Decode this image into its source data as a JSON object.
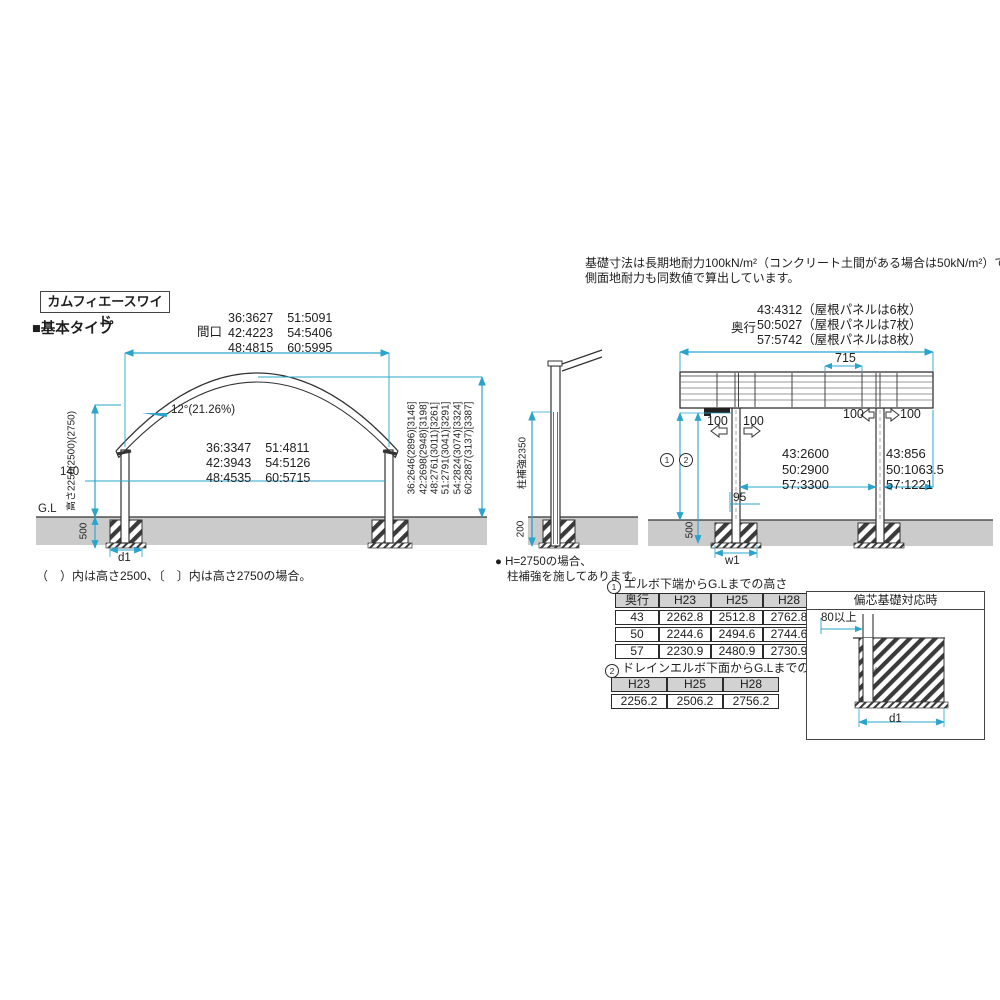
{
  "colors": {
    "accent": "#2AA4CC",
    "ground": "#cbcbcb",
    "line": "#333333",
    "table_header_bg": "#d2d2d2"
  },
  "header": {
    "product_name": "カムフィエースワイド",
    "section_title": "■基本タイプ"
  },
  "top_note": {
    "line1": "基礎寸法は長期地耐力100kN/m²（コンクリート土間がある場合は50kN/m²）での設定です。",
    "line2": "側面地耐力も同数値で算出しています。"
  },
  "front": {
    "width_prefix": "間口",
    "width_values": [
      [
        "36:3627",
        "51:5091"
      ],
      [
        "42:4223",
        "54:5406"
      ],
      [
        "48:4815",
        "60:5995"
      ]
    ],
    "slope_label": "12°(21.26%)",
    "inner_values": [
      [
        "36:3347",
        "51:4811"
      ],
      [
        "42:3943",
        "54:5126"
      ],
      [
        "48:4535",
        "60:5715"
      ]
    ],
    "height_label": "高さ2250(2500)(2750)",
    "dim_140": "140",
    "dim_500": "500",
    "gl_label": "G.L",
    "dim_d1": "d1",
    "total_heights": [
      "36:2646(2896)[3146]",
      "42:2698(2948)[3198]",
      "48:2761(3011)[3261]",
      "51:2791(3041)[3291]",
      "54:2824(3074)[3324]",
      "60:2887(3137)[3387]"
    ],
    "caption": "（　）内は高さ2500、〔　〕内は高さ2750の場合。"
  },
  "pillar": {
    "dim_label": "柱補強2350",
    "dim_200": "200",
    "note1": "● H=2750の場合、",
    "note2": "柱補強を施してあります。"
  },
  "side": {
    "depth_prefix": "奥行",
    "depth_values": [
      "43:4312（屋根パネルは6枚）",
      "50:5027（屋根パネルは7枚）",
      "57:5742（屋根パネルは8枚）"
    ],
    "dim_715": "715",
    "dim_100": "100",
    "span_values": [
      "43:2600",
      "50:2900",
      "57:3300"
    ],
    "overhang_values": [
      "43:856",
      "50:1063.5",
      "57:1221"
    ],
    "dim_95": "95",
    "dim_500": "500",
    "dim_w1": "w1",
    "circ1": "1",
    "circ2": "2"
  },
  "tables": {
    "t1_num": "1",
    "t1_title": "エルボ下端からG.Lまでの高さ",
    "t1_headers": [
      "奥行",
      "H23",
      "H25",
      "H28"
    ],
    "t1_rows": [
      [
        "43",
        "2262.8",
        "2512.8",
        "2762.8"
      ],
      [
        "50",
        "2244.6",
        "2494.6",
        "2744.6"
      ],
      [
        "57",
        "2230.9",
        "2480.9",
        "2730.9"
      ]
    ],
    "t2_num": "2",
    "t2_title": "ドレインエルボ下面からG.Lまでの高さ",
    "t2_headers": [
      "H23",
      "H25",
      "H28"
    ],
    "t2_rows": [
      [
        "2256.2",
        "2506.2",
        "2756.2"
      ]
    ]
  },
  "ecc": {
    "title": "偏芯基礎対応時",
    "dim_80": "80以上",
    "dim_d1": "d1"
  }
}
